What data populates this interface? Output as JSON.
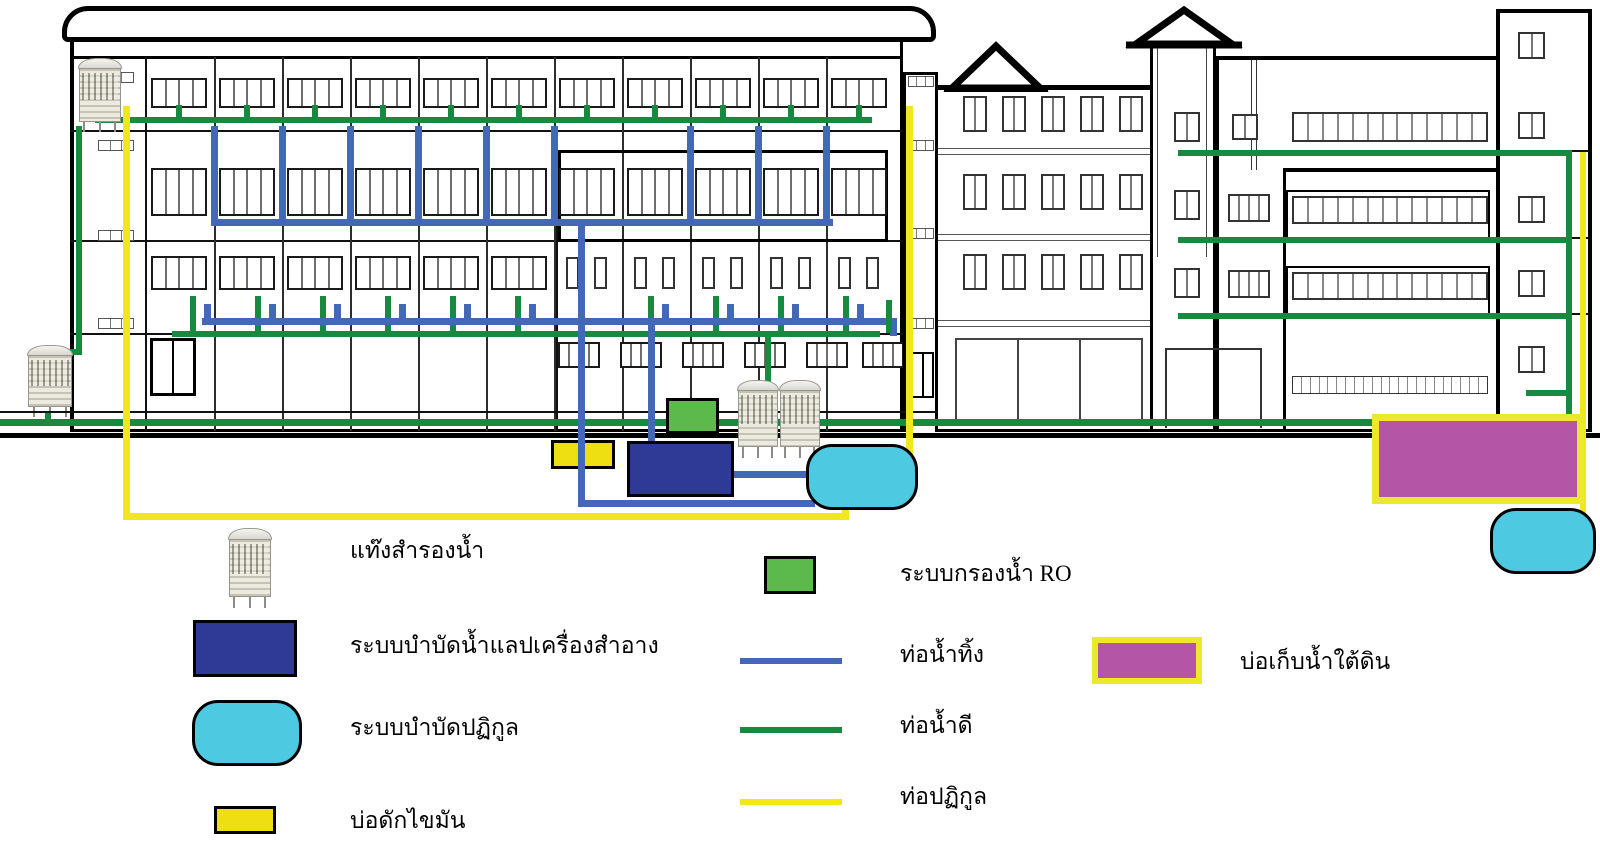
{
  "diagram_title": "",
  "colors": {
    "outline": "#000000",
    "clean_pipe": "#178a40",
    "waste_pipe": "#4468b8",
    "sewage_pipe": "#f2e71c",
    "ro_green": "#5cb94c",
    "lab_navy": "#2e3b96",
    "septic_cyan": "#4dc9e2",
    "grease_yellow": "#eedf12",
    "underground_magenta": "#b455a6",
    "underground_border": "#ece82b",
    "window_frame": "#1a1a1a",
    "pane_divider": "#6e6e6e"
  },
  "legend": {
    "col1": [
      {
        "icon": "water-tank-icon",
        "label": "แท๊งสำรองน้ำ"
      },
      {
        "icon": "lab-treatment-swatch",
        "label": "ระบบบำบัดน้ำแลปเครื่องสำอาง"
      },
      {
        "icon": "septic-treatment-swatch",
        "label": "ระบบบำบัดปฏิกูล"
      },
      {
        "icon": "grease-trap-swatch",
        "label": "บ่อดักไขมัน"
      }
    ],
    "col2": [
      {
        "icon": "ro-filter-swatch",
        "label": "ระบบกรองน้ำ RO"
      },
      {
        "icon": "waste-pipe-line",
        "label": "ท่อน้ำทิ้ง"
      },
      {
        "icon": "clean-pipe-line",
        "label": "ท่อน้ำดี"
      },
      {
        "icon": "sewage-pipe-line",
        "label": "ท่อปฏิกูล"
      }
    ],
    "col3": [
      {
        "icon": "underground-tank-swatch",
        "label": "บ่อเก็บน้ำใต้ดิน"
      }
    ]
  }
}
